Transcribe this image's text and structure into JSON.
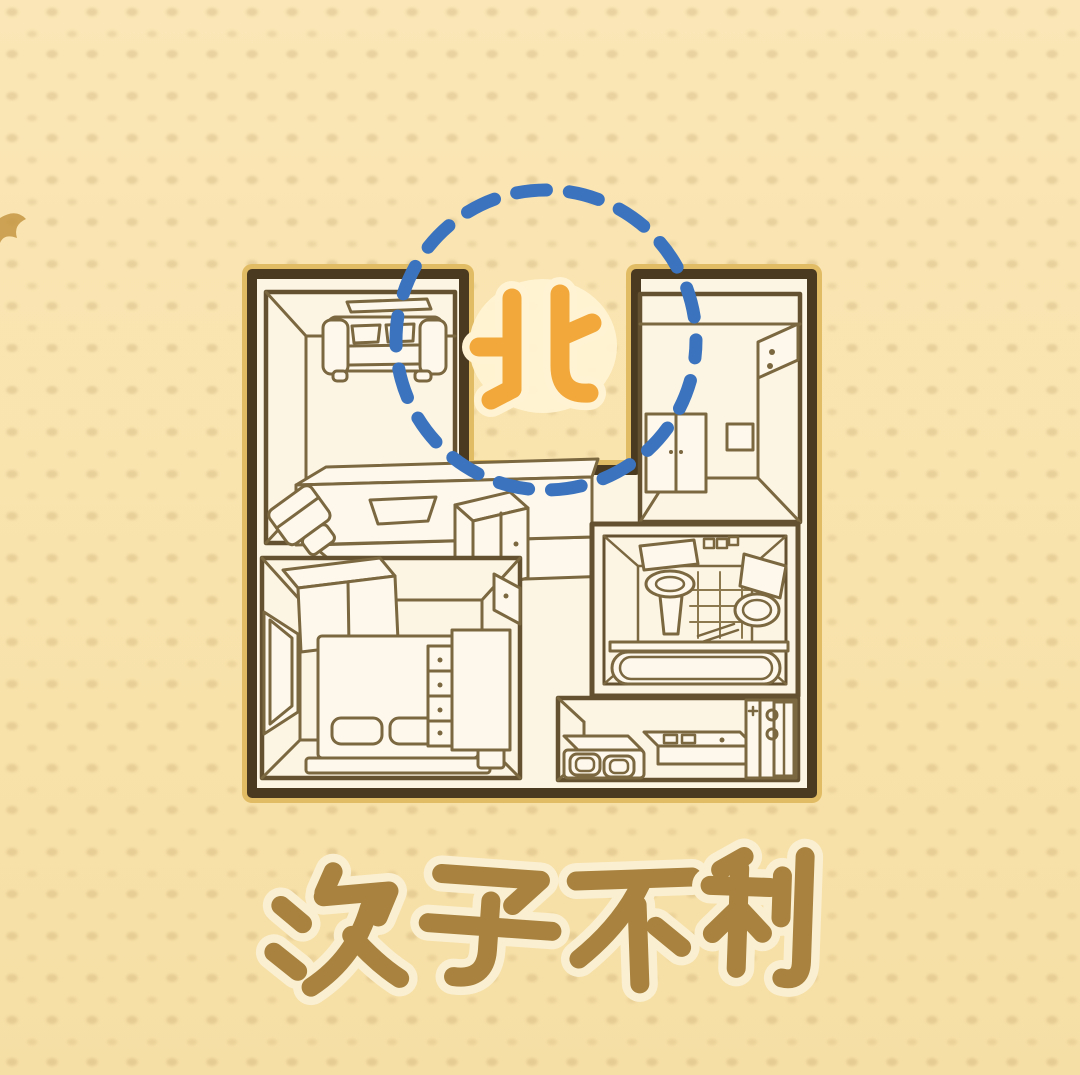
{
  "page": {
    "width": 1080,
    "height": 1075,
    "background": "#F9E3AE"
  },
  "compass": {
    "label": "北",
    "meaning": "north",
    "color": "#F2A83B",
    "halo_color": "#FFF3D3"
  },
  "highlight": {
    "shape": "dashed-circle",
    "color": "#3B73BF",
    "marks": "missing-north-corner"
  },
  "caption": {
    "text": "次子不利",
    "color": "#A8823E",
    "halo_color": "#FAEFD1"
  },
  "floor_plan": {
    "wall_color": "#4A3A20",
    "wall_outline_color": "#E2BC64",
    "floor_color": "#FCF5E3",
    "line_color": "#7B6740",
    "missing_corner": {
      "side": "north",
      "position": "top-center"
    },
    "rooms": [
      {
        "name": "living-room",
        "position": "top-left",
        "items": [
          "wall-shelf",
          "sofa",
          "double-bed",
          "nightstand"
        ]
      },
      {
        "name": "closet-room",
        "position": "top-right",
        "items": [
          "wardrobe",
          "wall-shelf",
          "picture-frame"
        ]
      },
      {
        "name": "bedroom",
        "position": "bottom-left",
        "items": [
          "wardrobe",
          "window",
          "bed",
          "pillows",
          "dresser",
          "wall-shelf"
        ]
      },
      {
        "name": "bathroom",
        "position": "middle-right",
        "items": [
          "vanity",
          "sink",
          "tiled-wall",
          "toilet",
          "towel-rack",
          "bathtub"
        ]
      },
      {
        "name": "kitchen",
        "position": "bottom-right",
        "items": [
          "stove",
          "counter",
          "refrigerator"
        ]
      },
      {
        "name": "hallway",
        "position": "center",
        "items": [
          "cabinet"
        ]
      }
    ]
  }
}
